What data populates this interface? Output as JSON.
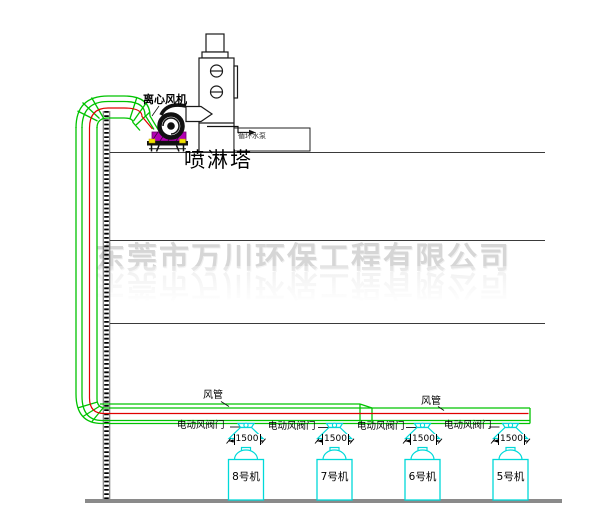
{
  "watermark": {
    "text": "东莞市万川环保工程有限公司"
  },
  "labels": {
    "fan": "离心风机",
    "tower": "喷淋塔",
    "tank": "循环水泵"
  },
  "duct_labels": [
    {
      "text": "风管"
    },
    {
      "text": "风管"
    }
  ],
  "valves": [
    {
      "label": "电动风阀门"
    },
    {
      "label": "电动风阀门"
    },
    {
      "label": "电动风阀门"
    },
    {
      "label": "电动风阀门"
    }
  ],
  "dimensions": [
    {
      "value": "1500"
    },
    {
      "value": "1500"
    },
    {
      "value": "1500"
    },
    {
      "value": "1500"
    }
  ],
  "machines": [
    {
      "label": "8号机"
    },
    {
      "label": "7号机"
    },
    {
      "label": "6号机"
    },
    {
      "label": "5号机"
    }
  ],
  "colors": {
    "duct_green": "#00c300",
    "centerline_red": "#e00000",
    "machine_cyan": "#00d9d9",
    "fan_base_magenta": "#b400b4",
    "stand_yellow": "#f0e000",
    "structure_black": "#1a1a1a",
    "ground_gray": "#8a8a8a",
    "watermark_gray": "#d6d6d6"
  }
}
